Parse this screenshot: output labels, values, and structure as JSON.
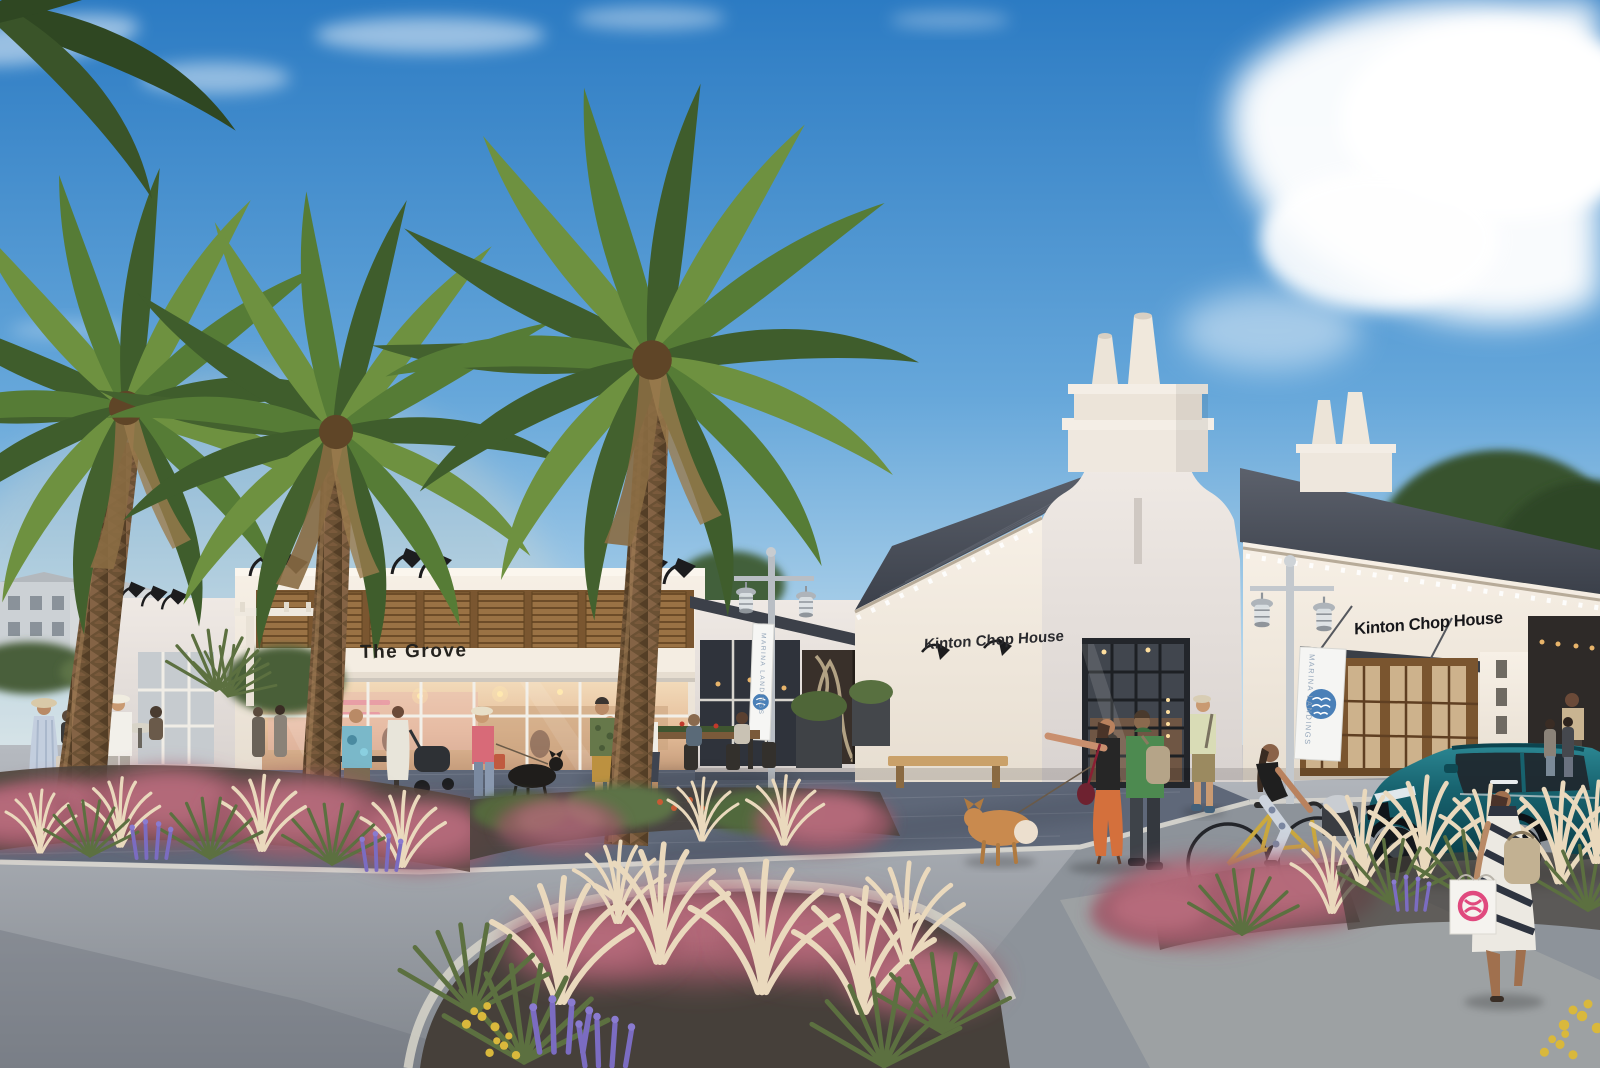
{
  "scene": {
    "signs": {
      "grove": "The Grove",
      "chophouse_wall": "Kinton Chop House",
      "chophouse_awning": "Kinton Chop House",
      "banner": "MARINA LANDINGS"
    },
    "palette": {
      "sky_top": "#2c7bc3",
      "sky_horizon": "#d6e8f3",
      "cloud": "#ffffff",
      "wall_lit": "#f6efe5",
      "wall_shaded": "#ece6e1",
      "roof_slate": "#474c57",
      "shutter_wood": "#95683c",
      "sign_text": "#222222",
      "banner_logo_blue": "#4a80b8",
      "suv_teal": "#17626e",
      "palm_green": "#567c36",
      "palm_trunk": "#6b5134",
      "muhly_pink": "#a45b6b",
      "plume_cream": "#ead9bd",
      "salvia_purple": "#7b6cc1",
      "promenade_pavers": "#5f6879",
      "asphalt": "#979da4"
    }
  }
}
